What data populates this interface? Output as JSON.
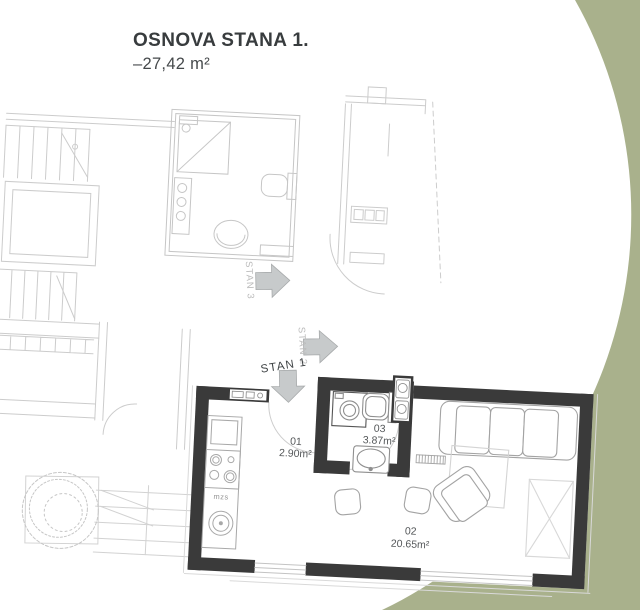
{
  "header": {
    "title": "OSNOVA STANA 1.",
    "area": "–27,42 m²"
  },
  "plan": {
    "rooms": [
      {
        "id": "01",
        "area": "2.90m²"
      },
      {
        "id": "02",
        "area": "20.65m²"
      },
      {
        "id": "03",
        "area": "3.87m²"
      }
    ],
    "unit_arrows": [
      {
        "label": "STAN 1",
        "direction": "down"
      },
      {
        "label": "STAN 2",
        "direction": "right"
      },
      {
        "label": "STAN 3",
        "direction": "right"
      }
    ],
    "kitchen_label": "mzs"
  },
  "colors": {
    "accent_green": "#A9B18C",
    "wall_dark": "#3A3A3A",
    "context_line": "#CCCCCC",
    "furniture_line": "#A3A3A3",
    "arrow_fill": "#C7CACB",
    "title_text": "#383C3E",
    "room_text": "#55585A"
  }
}
